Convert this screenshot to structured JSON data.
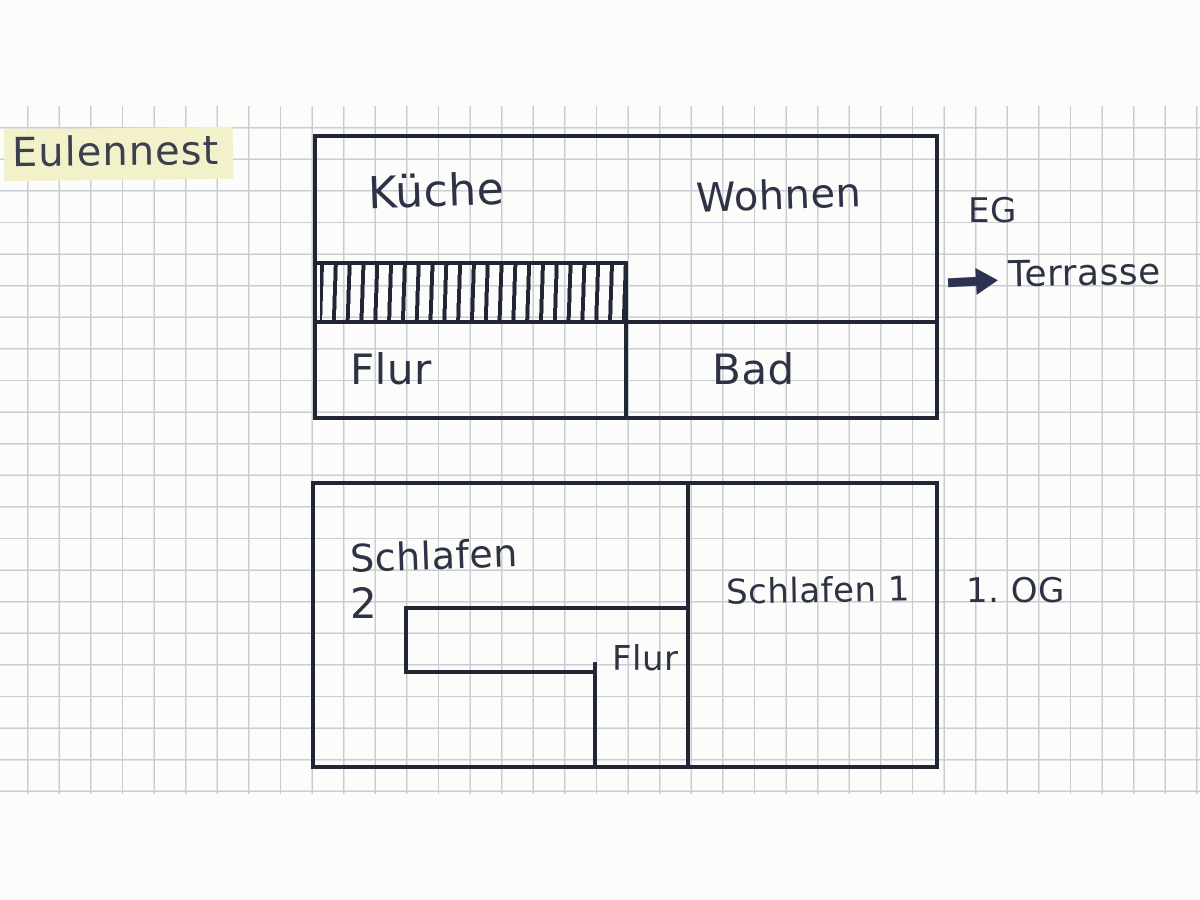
{
  "page": {
    "background_color": "#fcfcfa",
    "grid_color": "#aab0bc",
    "ink_color": "#212634",
    "text_color": "#2d3345",
    "highlight_color": "#f3f1ca"
  },
  "title": {
    "text": "Eulennest"
  },
  "eg": {
    "floor_label": "EG",
    "rooms": {
      "kueche": "Küche",
      "wohnen": "Wohnen",
      "flur": "Flur",
      "bad": "Bad"
    },
    "stairs_feature": "staircase-hatching",
    "terrasse": {
      "arrow_icon": "arrow-right",
      "label": "Terrasse"
    }
  },
  "og": {
    "floor_label": "1. OG",
    "rooms": {
      "schlafen2_line1": "Schlafen",
      "schlafen2_line2": "2",
      "flur": "Flur",
      "schlafen1": "Schlafen 1"
    }
  }
}
